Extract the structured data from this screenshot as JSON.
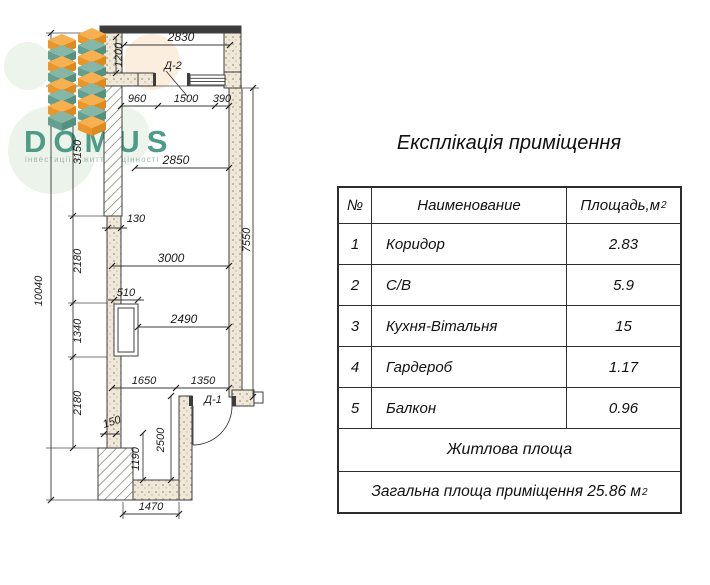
{
  "logo": {
    "name": "DOMUS",
    "tagline": "інвестиції у життєві цінності",
    "colors": {
      "teal": "#4e9b88",
      "orange": "#f2a33c"
    }
  },
  "plan": {
    "doors": {
      "d1": "Д-1",
      "d2": "Д-2"
    },
    "dims": {
      "w2830": "2830",
      "v1200": "1200",
      "w960": "960",
      "w1500": "1500",
      "w390": "390",
      "w2850": "2850",
      "v3150": "3150",
      "w130": "130",
      "v2180a": "2180",
      "w3000": "3000",
      "w510": "510",
      "v1340": "1340",
      "w2490": "2490",
      "w1650": "1650",
      "w1350": "1350",
      "v2180b": "2180",
      "w150": "150",
      "v1190": "1190",
      "v2500": "2500",
      "v7550": "7550",
      "v10040": "10040",
      "w1470": "1470"
    }
  },
  "table": {
    "title": "Експлікація приміщення",
    "headers": {
      "num": "№",
      "name": "Наименование",
      "area": "Площадь,м",
      "area_sup": "2"
    },
    "rows": [
      {
        "num": "1",
        "name": "Коридор",
        "area": "2.83"
      },
      {
        "num": "2",
        "name": "С/В",
        "area": "5.9"
      },
      {
        "num": "3",
        "name": "Кухня-Вітальня",
        "area": "15"
      },
      {
        "num": "4",
        "name": "Гардероб",
        "area": "1.17"
      },
      {
        "num": "5",
        "name": "Балкон",
        "area": "0.96"
      }
    ],
    "footer_living": "Житлова площа",
    "footer_total": "Загальна площа приміщення 25.86 м",
    "footer_total_sup": "2"
  }
}
